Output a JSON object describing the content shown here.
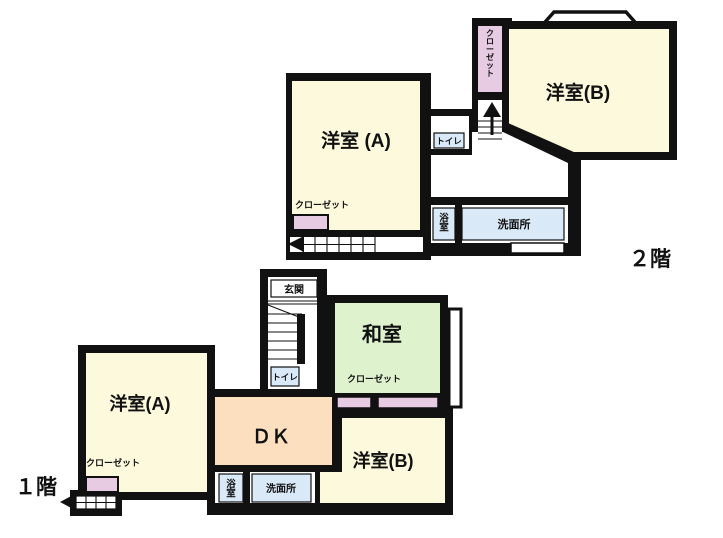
{
  "title": "間取り図",
  "colors": {
    "wall": "#111111",
    "room_cream": "#fcf9dc",
    "tatami_green": "#dff2ce",
    "dk_peach": "#fcdfbe",
    "water_blue": "#d9e9f7",
    "closet_pink": "#e7cbe3",
    "floor_white": "#ffffff"
  },
  "floor2": {
    "label": "２階",
    "rooms": {
      "yoshitsu_a": "洋室 (A)",
      "yoshitsu_b": "洋室(B)",
      "closet_a": "クローゼット",
      "closet_column": "クローゼット",
      "toilet": "トイレ",
      "bath": "浴室",
      "washroom": "洗面所"
    }
  },
  "floor1": {
    "label": "１階",
    "rooms": {
      "genkan": "玄関",
      "toilet": "トイレ",
      "washitsu": "和室",
      "closet_washitsu": "クローゼット",
      "yoshitsu_a": "洋室(A)",
      "closet_a": "クローゼット",
      "dk": "ＤＫ",
      "yoshitsu_b": "洋室(B)",
      "bath": "浴室",
      "washroom": "洗面所"
    }
  }
}
